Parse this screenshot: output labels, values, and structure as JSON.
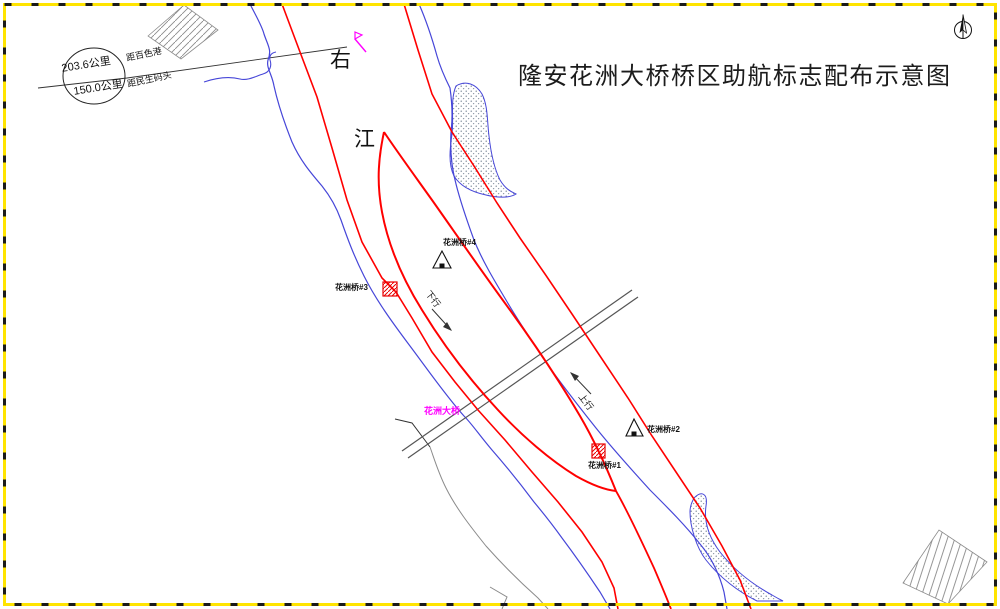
{
  "title": "隆安花洲大桥桥区助航标志配布示意图",
  "distance_circle": {
    "upper_value": "203.6公里",
    "lower_value": "150.0公里",
    "upper_label": "距百色港",
    "lower_label": "距民生码头"
  },
  "river": {
    "name_upper": "右",
    "name_lower": "江"
  },
  "channel": {
    "downstream_label": "下行",
    "upstream_label": "上行"
  },
  "bridge": {
    "label": "花洲大桥"
  },
  "beacons": {
    "b4": {
      "label": "花洲桥#4",
      "type": "triangle-daymark"
    },
    "b3": {
      "label": "花洲桥#3",
      "type": "square-daymark"
    },
    "b2": {
      "label": "花洲桥#2",
      "type": "triangle-daymark"
    },
    "b1": {
      "label": "花洲桥#1",
      "type": "square-daymark"
    }
  },
  "icons": {
    "compass": "north-arrow-icon",
    "beacon_flag": "light-beacon-icon"
  },
  "colors": {
    "channel_line": "#ff0000",
    "shoreline": "#4646d8",
    "bridge_label": "#ff00ff",
    "border_yellow": "#ffe400",
    "beacon_red": "#e80000"
  }
}
